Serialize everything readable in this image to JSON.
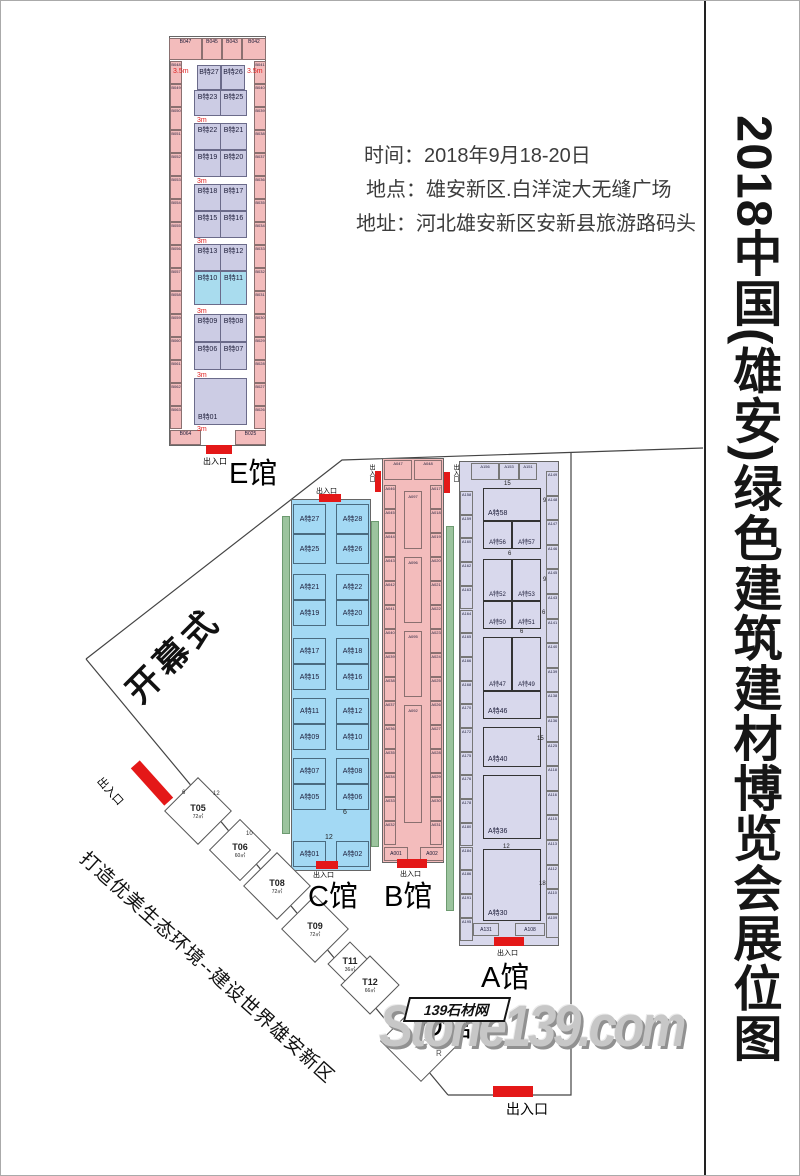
{
  "page": {
    "title": "2018中国(雄安)绿色建筑建材博览会展位图"
  },
  "info": {
    "line1": "时间：2018年9月18-20日",
    "line2": "地点：雄安新区.白洋淀大无缝广场",
    "line3": "地址：河北雄安新区安新县旅游路码头"
  },
  "labels": {
    "entrance": "出入口",
    "opening": "开幕式",
    "slogan": "打造优美生态环境--建设世界雄安新区",
    "aisle_3m": "3m",
    "aisle_35m": "3.5m",
    "north_marker": "R"
  },
  "watermark": {
    "brand": "Stone139.com",
    "site": "139石材网"
  },
  "colors": {
    "booth_pink": "#f3bcbc",
    "booth_purple": "#ccccе4",
    "booth_cyan": "#a9dcee",
    "hall_c_blue": "#a3d9f4",
    "hall_a_purple": "#d8d8ec",
    "green_strip": "#9cc49e",
    "entrance_red": "#e41818"
  },
  "halls": {
    "e": {
      "name": "E馆",
      "top_row": [
        "B047",
        "B045",
        "B043",
        "B042"
      ],
      "left_col": [
        "B048",
        "B049",
        "B050",
        "B051",
        "B052",
        "B053",
        "B054",
        "B055",
        "B056",
        "B057",
        "B058",
        "B059",
        "B060",
        "B061",
        "B062",
        "B063"
      ],
      "right_col": [
        "B041",
        "B040",
        "B039",
        "B038",
        "B037",
        "B036",
        "B035",
        "B034",
        "B033",
        "B032",
        "B031",
        "B030",
        "B029",
        "B028",
        "B027",
        "B026"
      ],
      "bottom_row": [
        "B064",
        "B025"
      ],
      "inner_rows": [
        [
          "B特27",
          "B特26"
        ],
        [
          "B特23",
          "B特25"
        ],
        [
          "B特22",
          "B特21"
        ],
        [
          "B特19",
          "B特20"
        ],
        [
          "B特18",
          "B特17"
        ],
        [
          "B特15",
          "B特16"
        ],
        [
          "B特13",
          "B特12"
        ],
        [
          "B特10",
          "B特11"
        ],
        [
          "B特09",
          "B特08"
        ],
        [
          "B特06",
          "B特07"
        ]
      ],
      "big_booth": "B特01"
    },
    "c": {
      "name": "C馆",
      "pairs": [
        [
          "A特27",
          "A特28"
        ],
        [
          "A特25",
          "A特26"
        ],
        [
          "A特21",
          "A特22"
        ],
        [
          "A特19",
          "A特20"
        ],
        [
          "A特17",
          "A特18"
        ],
        [
          "A特15",
          "A特16"
        ],
        [
          "A特11",
          "A特12"
        ],
        [
          "A特09",
          "A特10"
        ],
        [
          "A特07",
          "A特08"
        ],
        [
          "A特05",
          "A特06"
        ],
        [
          "A特01",
          "A特02"
        ]
      ],
      "dims": [
        "6",
        "12"
      ]
    },
    "b": {
      "name": "B馆",
      "top_row": [
        "A047",
        "A048"
      ],
      "left_col": [
        "A046",
        "A045",
        "A044",
        "A043",
        "A042",
        "A041",
        "A040",
        "A039",
        "A038",
        "A037",
        "A036",
        "A035",
        "A034",
        "A033",
        "A032"
      ],
      "right_col": [
        "A017",
        "A018",
        "A019",
        "A020",
        "A021",
        "A022",
        "A023",
        "A024",
        "A025",
        "A026",
        "A027",
        "A028",
        "A029",
        "A030",
        "A031"
      ],
      "center_booths": [
        "A097",
        "A096",
        "A095",
        "A092"
      ],
      "bottom_row": [
        "A001",
        "A002"
      ]
    },
    "a": {
      "name": "A馆",
      "top_row": [
        "A156",
        "A153",
        "A151"
      ],
      "left_col": [
        "A158",
        "A159",
        "A160",
        "A162",
        "A163",
        "A164",
        "A165",
        "A166",
        "A168",
        "A170",
        "A172",
        "A175",
        "A176",
        "A178",
        "A180",
        "A184",
        "A186",
        "A191",
        "A195"
      ],
      "right_col": [
        "A149",
        "A148",
        "A147",
        "A146",
        "A145",
        "A143",
        "A141",
        "A140",
        "A139",
        "A138",
        "A136",
        "A125",
        "A118",
        "A116",
        "A115",
        "A113",
        "A112",
        "A110",
        "A109"
      ],
      "bottom_row": [
        "A131",
        "A108"
      ],
      "blocks": {
        "b58": "A特58",
        "pair1": [
          "A特56",
          "A特57"
        ],
        "pair2": [
          "A特52",
          "A特53"
        ],
        "pair3": [
          "A特50",
          "A特51"
        ],
        "pair4": [
          "A特47",
          "A特49"
        ],
        "b46": "A特46",
        "b40": "A特40",
        "b36": "A特36",
        "b30": "A特30"
      },
      "dims": [
        "15",
        "9",
        "6",
        "9",
        "6",
        "6",
        "15",
        "12",
        "18"
      ]
    },
    "d": {
      "name": "D馆",
      "booths": [
        {
          "id": "T05",
          "area": "72㎡"
        },
        {
          "id": "T06",
          "area": "60㎡"
        },
        {
          "id": "T08",
          "area": "72㎡"
        },
        {
          "id": "T09",
          "area": "72㎡"
        },
        {
          "id": "T11",
          "area": "36㎡"
        },
        {
          "id": "T12",
          "area": "66㎡"
        },
        {
          "id": "T15",
          "area": "136㎡"
        }
      ],
      "dims": [
        "6",
        "12",
        "10"
      ]
    }
  }
}
